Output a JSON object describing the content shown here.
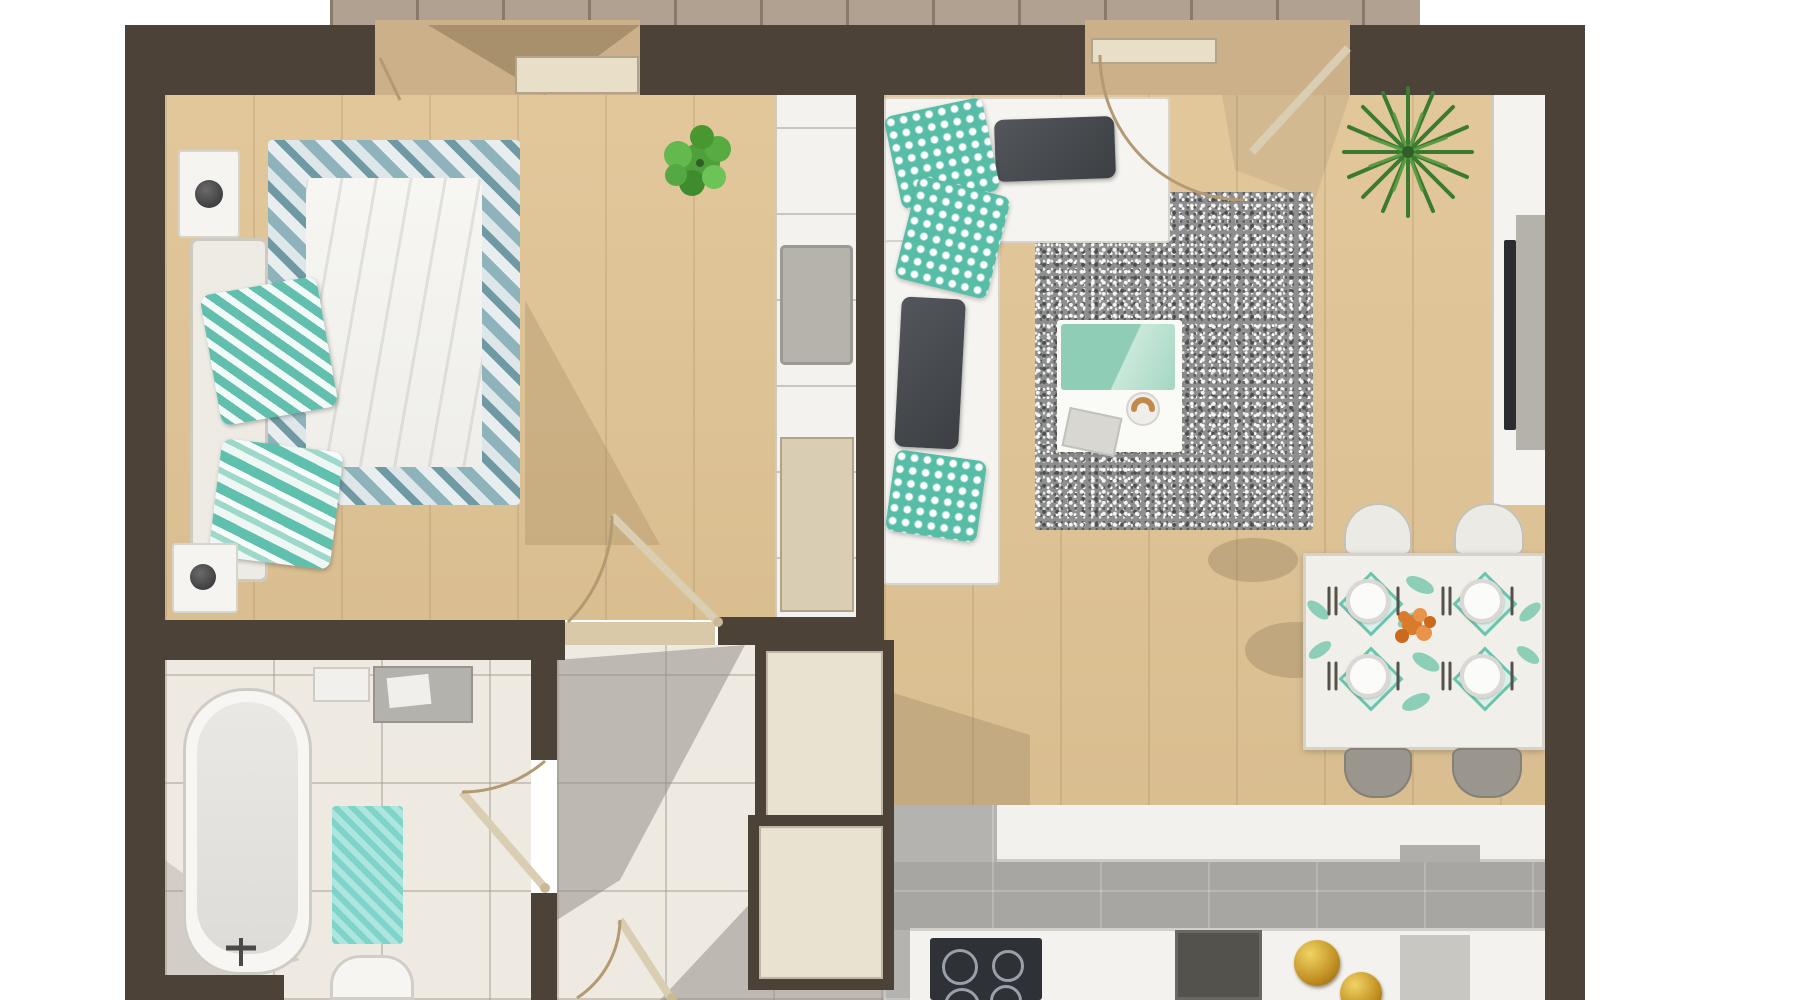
{
  "scene": {
    "kind": "top-down 3D rendered apartment floor plan",
    "background": "#ffffff",
    "text_labels_visible": "none"
  },
  "palette": {
    "wall": "#4d4238",
    "wood_floor": "#e0c495",
    "tile_light": "#eee9e1",
    "kitchen_floor": "#b5b3af",
    "deck": "#b1a191",
    "accent_teal": "#5abfa9",
    "dark_cushion": "#45484c",
    "rug_gray": "#8e8e8e",
    "closet_fill": "#e9e2d1",
    "counter_white": "#f3f2ee",
    "cooktop_black": "#2e3136",
    "gold": "#c99a2e",
    "plant_green": "#56ae3f",
    "palm_green": "#3c7a31",
    "door_arc": "#b39a72",
    "flower_orange": "#d97b2a"
  },
  "rooms": {
    "bedroom": {
      "name": "bedroom",
      "floor": "wood"
    },
    "bathroom": {
      "name": "bathroom",
      "floor": "tile"
    },
    "hallway": {
      "name": "hallway",
      "floor": "tile"
    },
    "living_dining": {
      "name": "living and dining room",
      "floor": "wood"
    },
    "kitchen": {
      "name": "kitchen",
      "floor": "gray tile"
    },
    "balcony": {
      "name": "balcony",
      "floor": "wood deck"
    }
  },
  "furniture": {
    "bed": {
      "label": "double bed with chevron blanket and white duvet"
    },
    "headboard": {
      "label": "bed headboard bench"
    },
    "nightstands": {
      "label": "two nightstands with round lamps"
    },
    "bed_pillows": {
      "label": "teal chevron pillows"
    },
    "wardrobe_column": {
      "label": "built-in wardrobe with seat cushion"
    },
    "bedroom_plant": {
      "label": "green potted plant"
    },
    "sofa": {
      "label": "white L-shaped sectional sofa"
    },
    "sofa_pillows": {
      "label": "dark gray and teal quatrefoil pillows"
    },
    "rug": {
      "label": "speckled gray rug"
    },
    "coffee_table": {
      "label": "white coffee table with teal blanket, book and croissant plate"
    },
    "tv_console": {
      "label": "TV media console along right wall"
    },
    "palm_plant": {
      "label": "palm houseplant"
    },
    "dining_table": {
      "label": "dining table with four place settings and orange flowers"
    },
    "dining_chairs": {
      "label": "two white and two gray chairs"
    },
    "kitchen_peninsula": {
      "label": "white kitchen peninsula counter"
    },
    "kitchen_counter": {
      "label": "kitchen counter with cooktop and sink"
    },
    "cooktop": {
      "label": "black four-burner cooktop"
    },
    "gold_decor": {
      "label": "gold decorative spheres"
    },
    "bathtub": {
      "label": "bathtub with floor faucet"
    },
    "bath_mat": {
      "label": "teal bath mat"
    },
    "vanity": {
      "label": "gray bathroom vanity"
    },
    "toilet": {
      "label": "toilet (partially visible)"
    },
    "hall_closets": {
      "label": "two framed hallway closets"
    },
    "doors": {
      "label": "swing doors with arc symbols, two balcony doors"
    }
  }
}
